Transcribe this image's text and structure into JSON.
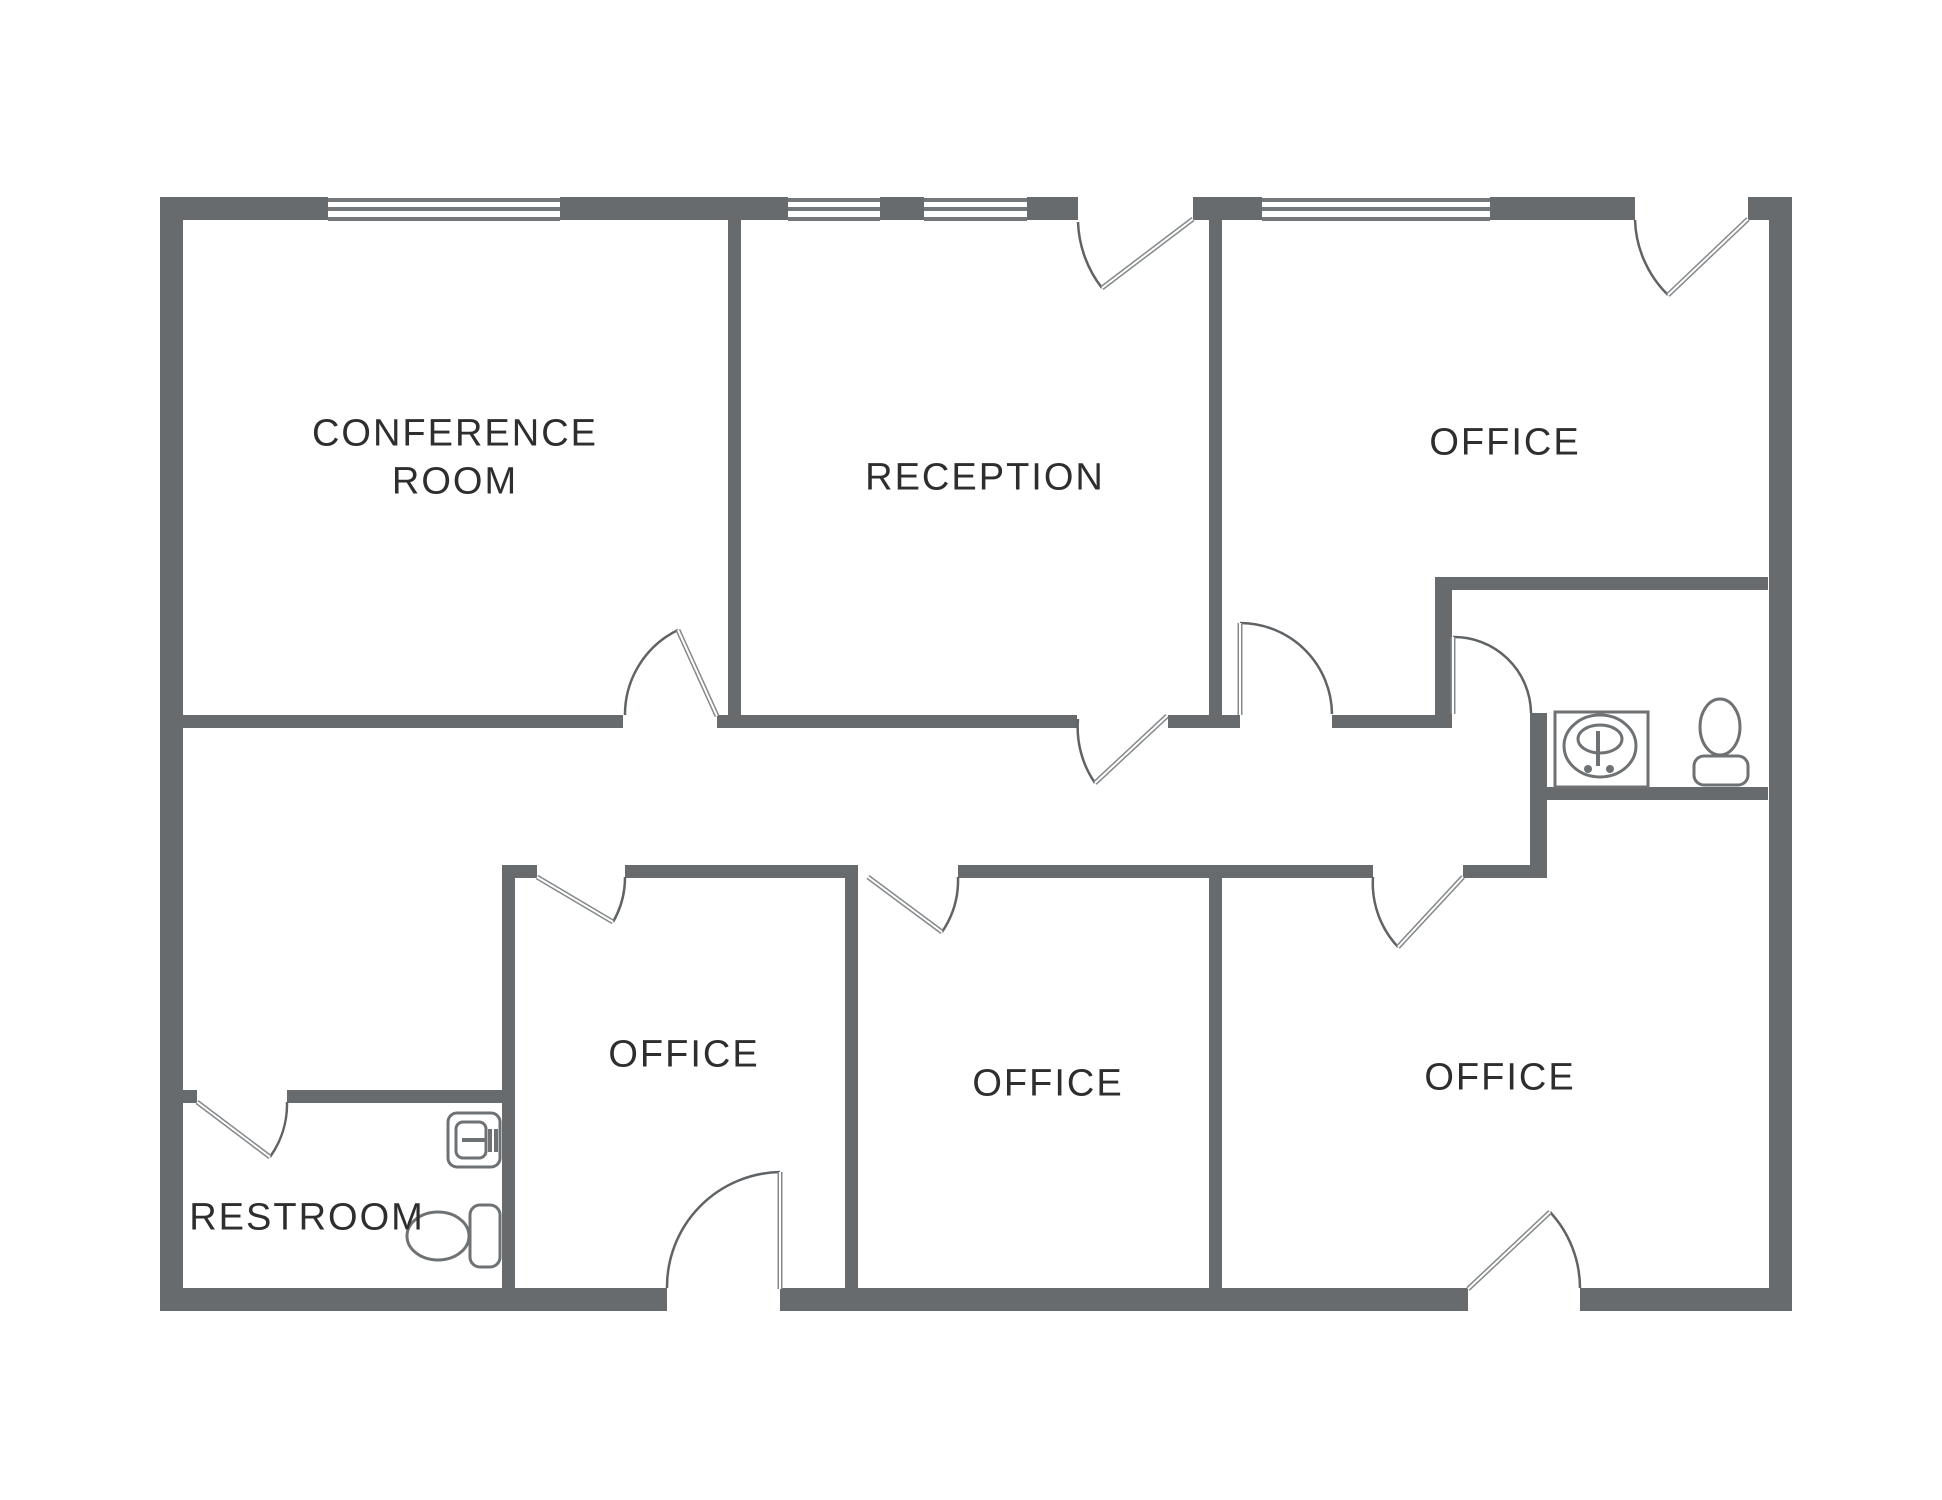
{
  "canvas": {
    "width": 1942,
    "height": 1500,
    "background": "#ffffff"
  },
  "colors": {
    "canvas_bg": "#ffffff",
    "wall": "#676b6d",
    "window_line": "#74787a",
    "door_arc": "#5f6365",
    "door_line": "#85898b",
    "fixture": "#6e7274",
    "label": "#2e2e2e"
  },
  "rooms": [
    {
      "id": "conference-room",
      "label": "CONFERENCE\nROOM"
    },
    {
      "id": "reception",
      "label": "RECEPTION"
    },
    {
      "id": "office-top-right",
      "label": "OFFICE"
    },
    {
      "id": "office-bottom-left",
      "label": "OFFICE"
    },
    {
      "id": "office-bottom-middle",
      "label": "OFFICE"
    },
    {
      "id": "office-bottom-right",
      "label": "OFFICE"
    },
    {
      "id": "restroom-bottom-left",
      "label": "RESTROOM"
    }
  ],
  "windows": [
    {
      "location": "conference-room top wall"
    },
    {
      "location": "reception top wall left segment"
    },
    {
      "location": "reception top wall right segment"
    },
    {
      "location": "office-top-right top wall"
    }
  ],
  "doors": [
    {
      "location": "conference-room from hallway"
    },
    {
      "location": "reception main entry (top wall)"
    },
    {
      "location": "office-top-right exterior entry (top wall)"
    },
    {
      "location": "reception to hallway"
    },
    {
      "location": "hallway to office-top-right lower lobe"
    },
    {
      "location": "hallway to middle-right restroom"
    },
    {
      "location": "office-bottom-left from hallway"
    },
    {
      "location": "office-bottom-middle from hallway"
    },
    {
      "location": "office-bottom-right from hallway"
    },
    {
      "location": "office-bottom-left exterior (bottom wall)"
    },
    {
      "location": "office-bottom-right exterior (bottom wall)"
    },
    {
      "location": "restroom-bottom-left entry"
    }
  ],
  "fixtures": {
    "restroom_middle_right": [
      "sink",
      "toilet"
    ],
    "restroom_bottom_left": [
      "sink",
      "toilet"
    ]
  }
}
